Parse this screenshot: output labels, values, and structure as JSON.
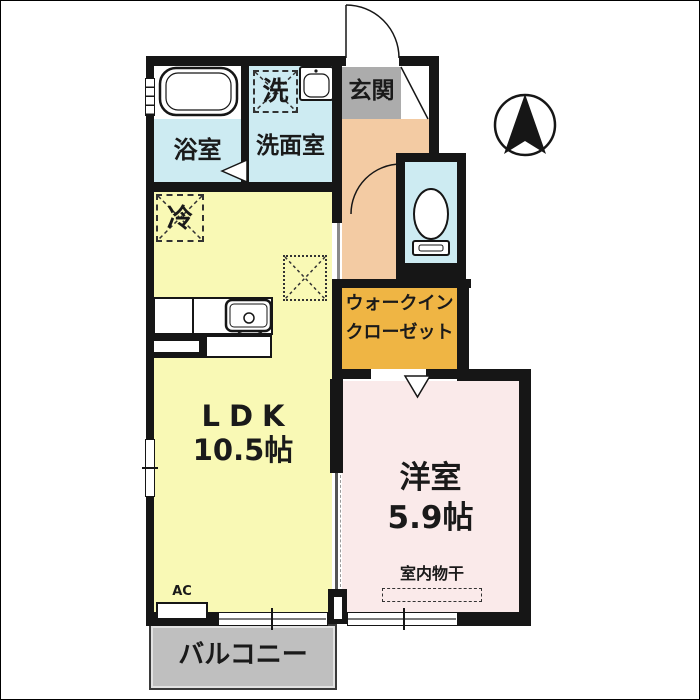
{
  "labels": {
    "bath": "浴室",
    "washroom": "洗面室",
    "laundry": "洗",
    "genkan": "玄関",
    "fridge": "冷",
    "ldk": "LDK",
    "ldk_size": "10.5帖",
    "wic_line1": "ウォークイン",
    "wic_line2": "クローゼット",
    "western": "洋室",
    "western_size": "5.9帖",
    "indoor_drying": "室内物干",
    "ac": "AC",
    "balcony": "バルコニー"
  },
  "icons": {
    "compass": "north-arrow-icon",
    "bathtub": "bathtub-icon",
    "washbasin": "washbasin-icon",
    "kitchen_sink": "kitchen-sink-icon",
    "toilet": "toilet-icon"
  },
  "colors": {
    "wall": "#161616",
    "ldk": "#F9F9B5",
    "western": "#FAEAEA",
    "wet": "#CDEBF2",
    "hall": "#F3CBA3",
    "wic": "#EFB544",
    "genkan": "#ACACAC",
    "balcony": "#BFBFBF"
  }
}
